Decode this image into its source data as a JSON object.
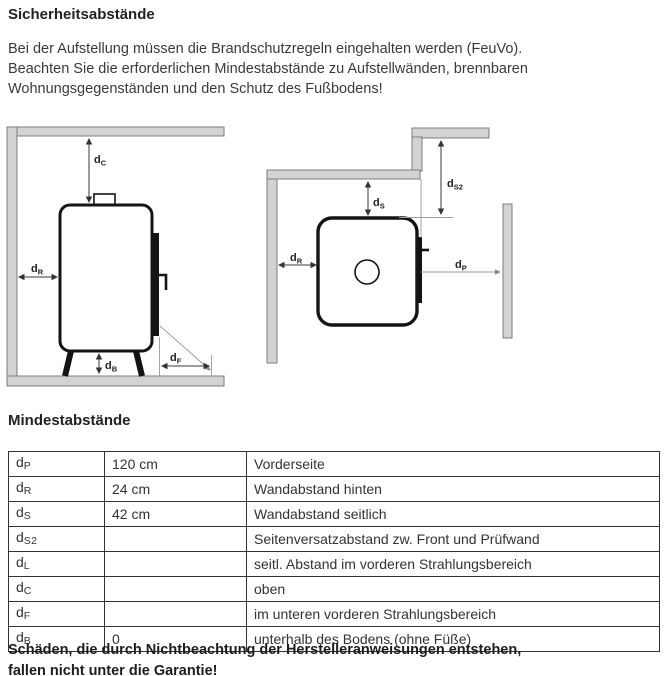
{
  "page": {
    "title": "Sicherheitsabstände",
    "intro_lines": [
      "Bei der Aufstellung müssen die Brandschutzregeln eingehalten werden (FeuVo).",
      "Beachten Sie die erforderlichen Mindestabstände zu Aufstellwänden, brennbaren",
      "Wohnungsgegenständen und den Schutz des Fußbodens!"
    ],
    "section_heading": "Mindestabstände",
    "warning_lines": [
      "Schäden, die durch Nichtbeachtung der Herstelleranweisungen entstehen,",
      "fallen nicht unter die Garantie!"
    ]
  },
  "diagrams": {
    "side_view": {
      "labels": {
        "dc": {
          "base": "d",
          "sub": "C"
        },
        "dr": {
          "base": "d",
          "sub": "R"
        },
        "db": {
          "base": "d",
          "sub": "B"
        },
        "df": {
          "base": "d",
          "sub": "F"
        }
      }
    },
    "top_view": {
      "labels": {
        "ds": {
          "base": "d",
          "sub": "S"
        },
        "ds2": {
          "base": "d",
          "sub": "S2"
        },
        "dr": {
          "base": "d",
          "sub": "R"
        },
        "dp": {
          "base": "d",
          "sub": "P"
        }
      }
    }
  },
  "table": {
    "rows": [
      {
        "sym": "d",
        "sub": "P",
        "value": "120 cm",
        "desc": "Vorderseite"
      },
      {
        "sym": "d",
        "sub": "R",
        "value": "24 cm",
        "desc": "Wandabstand hinten"
      },
      {
        "sym": "d",
        "sub": "S",
        "value": "42 cm",
        "desc": "Wandabstand seitlich"
      },
      {
        "sym": "d",
        "sub": "S2",
        "value": "",
        "desc": "Seitenversatzabstand zw. Front und Prüfwand"
      },
      {
        "sym": "d",
        "sub": "L",
        "value": "",
        "desc": "seitl. Abstand im vorderen Strahlungsbereich"
      },
      {
        "sym": "d",
        "sub": "C",
        "value": "",
        "desc": "oben"
      },
      {
        "sym": "d",
        "sub": "F",
        "value": "",
        "desc": "im unteren vorderen Strahlungsbereich"
      },
      {
        "sym": "d",
        "sub": "B",
        "value": "0",
        "desc": "unterhalb des Bodens (ohne Füße)"
      }
    ]
  }
}
